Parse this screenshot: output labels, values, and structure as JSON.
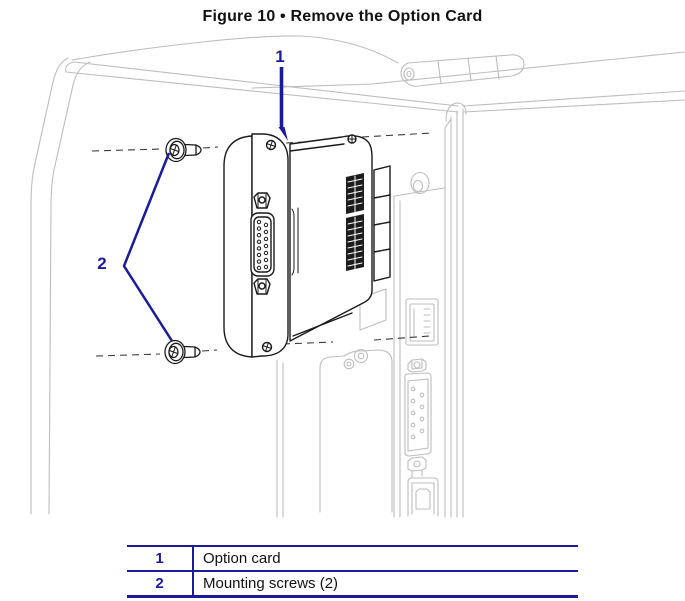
{
  "figure": {
    "title": "Figure 10 • Remove the Option Card"
  },
  "callouts": [
    {
      "label": "1",
      "target": "option card"
    },
    {
      "label": "2",
      "target": "mounting screws"
    }
  ],
  "legend": {
    "rows": [
      {
        "num": "1",
        "desc": "Option card"
      },
      {
        "num": "2",
        "desc": "Mounting screws (2)"
      }
    ]
  },
  "icons": [
    "ethernet-port-icon",
    "serial-port-icon",
    "usb-port-icon",
    "round-port-icon",
    "hinge-icon",
    "screw-icon",
    "db15-connector-icon"
  ],
  "colors": {
    "accent_navy": "#1b1b9a",
    "printer_line_gray": "#bdbdbd",
    "card_line_black": "#1a1a1a",
    "background": "#ffffff"
  }
}
